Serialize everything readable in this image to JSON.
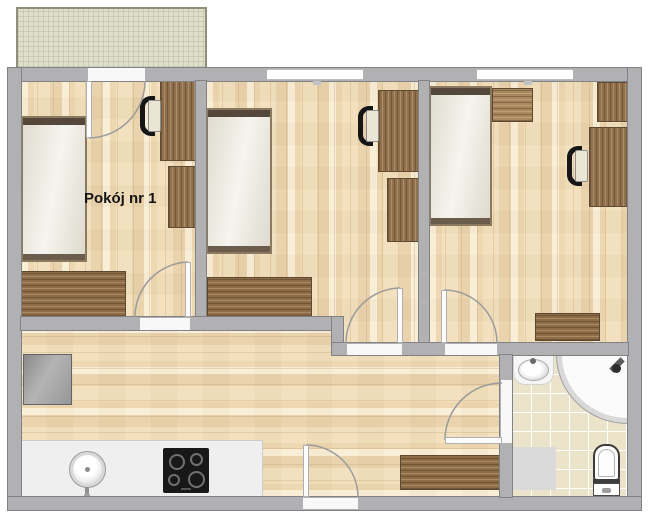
{
  "plan_title": "Apartment floor plan",
  "rooms": [
    {
      "id": "room-1",
      "label": "Pokój nr 1",
      "furniture": [
        "bed",
        "desk",
        "desk-chair",
        "cabinet",
        "wardrobe"
      ]
    },
    {
      "id": "room-2",
      "label": "",
      "furniture": [
        "bed",
        "desk",
        "desk-chair",
        "cabinet",
        "wardrobe"
      ]
    },
    {
      "id": "room-3",
      "label": "",
      "furniture": [
        "bed",
        "sideboard",
        "cabinet",
        "desk",
        "desk-chair",
        "dresser"
      ]
    },
    {
      "id": "kitchen-hall",
      "label": "",
      "furniture": [
        "fridge",
        "kitchen-counter",
        "kitchen-sink",
        "cooktop",
        "hall-cabinet"
      ]
    },
    {
      "id": "bathroom",
      "label": "",
      "furniture": [
        "washbasin",
        "corner-shower",
        "shower-head",
        "toilet",
        "mat"
      ]
    }
  ],
  "outdoor": {
    "balcony": "balcony"
  },
  "doors": [
    "balcony-door",
    "room1-door",
    "room2-door",
    "room3-door",
    "bathroom-door",
    "entrance-door"
  ],
  "windows": [
    "room2-window",
    "room3-window"
  ],
  "colors": {
    "wall": "#b1b1b3",
    "wall_outline": "#828286",
    "wood_floor": "#f1e0bf",
    "furniture_wood": "#91714d",
    "mattress": "#ebe7da",
    "balcony": "#e0dfcb",
    "bathroom_tile": "#ece3cb",
    "counter": "#efefef",
    "cooktop": "#181818",
    "door_arc": "#9b9b9b"
  }
}
